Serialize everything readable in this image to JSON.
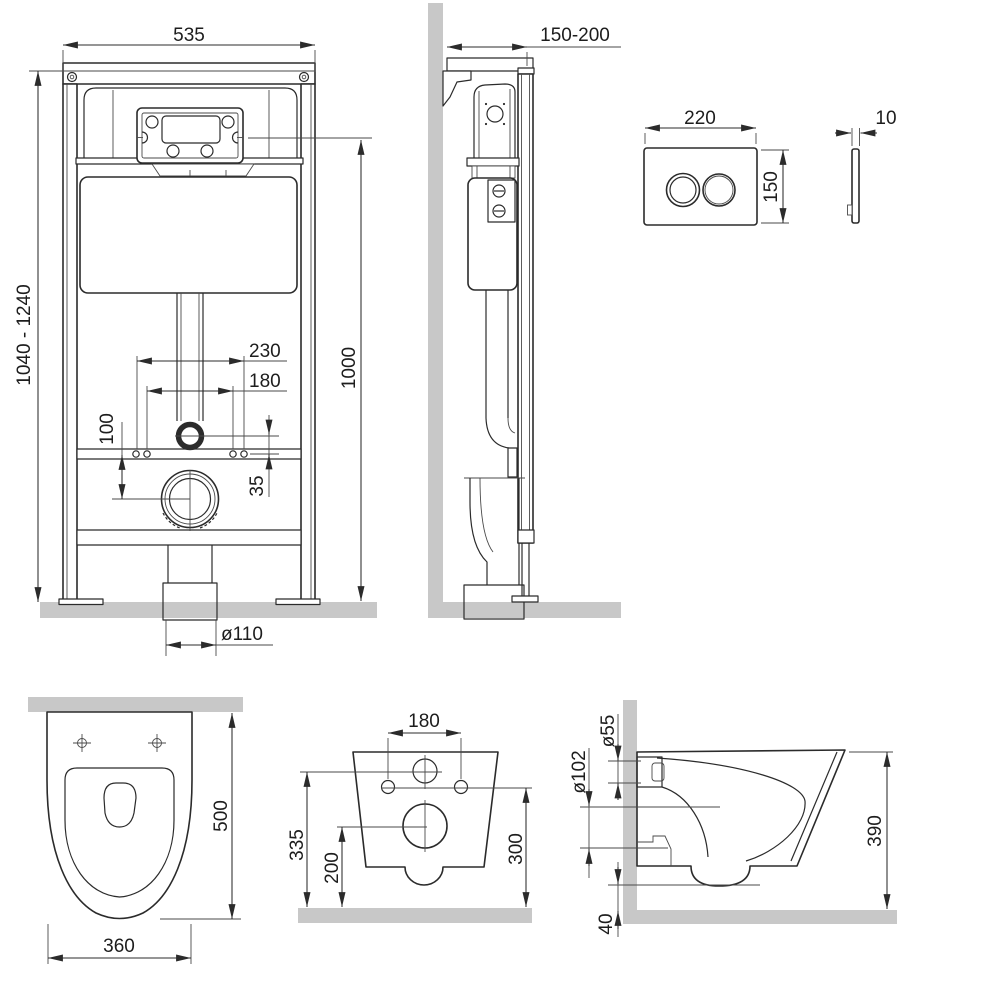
{
  "colors": {
    "line": "#2b2b2b",
    "construction": "#4a4a4a",
    "text": "#1d1d1d",
    "surface": "#c8c8c8"
  },
  "views": {
    "frame_front": {
      "dims": {
        "width": "535",
        "height_range": "1040 - 1240",
        "height_to_panel": "1000",
        "outer_bolt_spacing": "230",
        "inner_bolt_spacing": "180",
        "rail_to_drain": "100",
        "inlet_to_rail": "35",
        "drain_diameter": "ø110"
      }
    },
    "frame_side": {
      "dims": {
        "wall_distance": "150-200"
      }
    },
    "flush_plate": {
      "dims": {
        "width": "220",
        "height": "150",
        "thickness": "10"
      }
    },
    "bowl_top": {
      "dims": {
        "depth": "500",
        "width": "360"
      }
    },
    "bowl_rear": {
      "dims": {
        "bolt_spacing": "180",
        "inlet_height": "335",
        "drain_height": "200",
        "bolt_height": "300"
      }
    },
    "bowl_side": {
      "dims": {
        "inlet_diameter": "ø55",
        "drain_diameter": "ø102",
        "height": "390",
        "floor_clearance": "40"
      }
    }
  }
}
